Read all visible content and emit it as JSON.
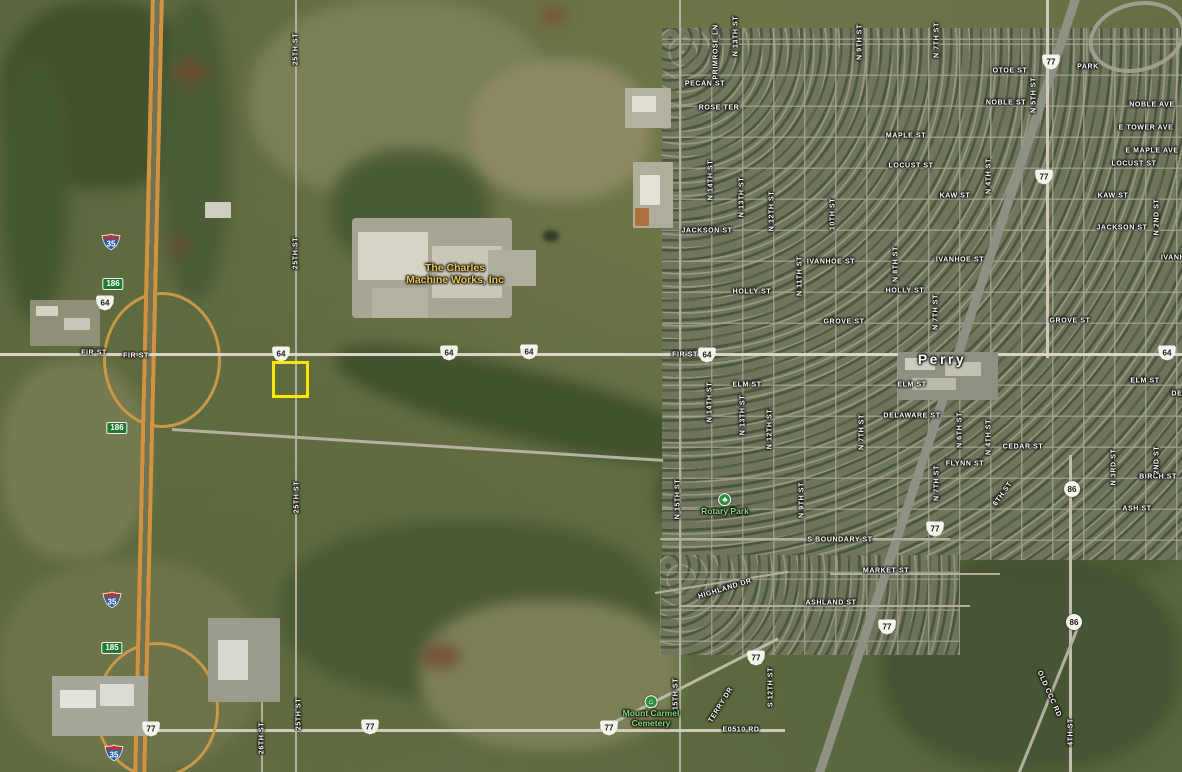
{
  "map": {
    "type": "satellite",
    "city": {
      "name": "Perry"
    },
    "selection": {
      "x": 272,
      "y": 361,
      "w": 31,
      "h": 31,
      "color": "#ffe800"
    },
    "pois": [
      {
        "name": "charles-machine-works",
        "style": "business",
        "x": 455,
        "y": 274,
        "lines": [
          "The Charles",
          "Machine Works, Inc"
        ]
      },
      {
        "name": "rotary-park",
        "style": "park",
        "icon": "tree-icon",
        "glyph": "♣",
        "x": 725,
        "y": 505,
        "lines": [
          "Rotary Park"
        ]
      },
      {
        "name": "mount-carmel-cemetery",
        "style": "park",
        "icon": "cemetery-icon",
        "glyph": "⌂",
        "x": 651,
        "y": 712,
        "lines": [
          "Mount Carmel",
          "Cemetery"
        ]
      }
    ],
    "street_labels": [
      {
        "t": "Perry",
        "x": 942,
        "y": 359,
        "k": "city"
      },
      {
        "t": "PECAN ST",
        "x": 705,
        "y": 84
      },
      {
        "t": "ROSE TER",
        "x": 719,
        "y": 108
      },
      {
        "t": "OTOE ST",
        "x": 1010,
        "y": 71
      },
      {
        "t": "PARK",
        "x": 1088,
        "y": 67
      },
      {
        "t": "NOBLE ST",
        "x": 1006,
        "y": 103
      },
      {
        "t": "NOBLE AVE",
        "x": 1152,
        "y": 105
      },
      {
        "t": "E TOWER AVE",
        "x": 1146,
        "y": 128
      },
      {
        "t": "E MAPLE AVE",
        "x": 1152,
        "y": 151
      },
      {
        "t": "MAPLE ST",
        "x": 906,
        "y": 136
      },
      {
        "t": "LOCUST ST",
        "x": 911,
        "y": 166
      },
      {
        "t": "LOCUST ST",
        "x": 1134,
        "y": 164
      },
      {
        "t": "KAW ST",
        "x": 955,
        "y": 196
      },
      {
        "t": "KAW ST",
        "x": 1113,
        "y": 196
      },
      {
        "t": "JACKSON ST",
        "x": 707,
        "y": 231
      },
      {
        "t": "JACKSON ST",
        "x": 1122,
        "y": 228
      },
      {
        "t": "IVANHOE ST",
        "x": 831,
        "y": 262
      },
      {
        "t": "IVANHOE ST",
        "x": 960,
        "y": 260
      },
      {
        "t": "IVANHOE ST",
        "x": 1185,
        "y": 258
      },
      {
        "t": "HOLLY ST",
        "x": 752,
        "y": 292
      },
      {
        "t": "HOLLY ST",
        "x": 905,
        "y": 291
      },
      {
        "t": "GROVE ST",
        "x": 844,
        "y": 322
      },
      {
        "t": "GROVE ST",
        "x": 1070,
        "y": 321
      },
      {
        "t": "FIR ST",
        "x": 94,
        "y": 353
      },
      {
        "t": "FIR ST",
        "x": 136,
        "y": 356
      },
      {
        "t": "FIR ST",
        "x": 685,
        "y": 355
      },
      {
        "t": "ELM ST",
        "x": 747,
        "y": 385
      },
      {
        "t": "ELM ST",
        "x": 912,
        "y": 385
      },
      {
        "t": "ELM ST",
        "x": 1145,
        "y": 381
      },
      {
        "t": "DELAWARE ST",
        "x": 912,
        "y": 416
      },
      {
        "t": "DELAWARE ST",
        "x": 1200,
        "y": 394
      },
      {
        "t": "CEDAR ST",
        "x": 1023,
        "y": 447
      },
      {
        "t": "FLYNN ST",
        "x": 965,
        "y": 464
      },
      {
        "t": "BIRCH ST",
        "x": 1158,
        "y": 477
      },
      {
        "t": "ASH ST",
        "x": 1137,
        "y": 509
      },
      {
        "t": "S BOUNDARY ST",
        "x": 840,
        "y": 540
      },
      {
        "t": "MARKET ST",
        "x": 886,
        "y": 571
      },
      {
        "t": "ASHLAND ST",
        "x": 831,
        "y": 603
      },
      {
        "t": "E0510 RD",
        "x": 741,
        "y": 730
      },
      {
        "t": "PRIMROSE LN",
        "x": 716,
        "y": 52,
        "r": -90
      },
      {
        "t": "N 13TH ST",
        "x": 736,
        "y": 36,
        "r": -90
      },
      {
        "t": "N 9TH ST",
        "x": 860,
        "y": 42,
        "r": -90
      },
      {
        "t": "N 7TH ST",
        "x": 937,
        "y": 40,
        "r": -90
      },
      {
        "t": "N 5TH ST",
        "x": 1034,
        "y": 95,
        "r": -90
      },
      {
        "t": "N 4TH ST",
        "x": 989,
        "y": 176,
        "r": -90
      },
      {
        "t": "N 2ND ST",
        "x": 1157,
        "y": 217,
        "r": -90
      },
      {
        "t": "N 14TH ST",
        "x": 711,
        "y": 180,
        "r": -90
      },
      {
        "t": "N 13TH ST",
        "x": 742,
        "y": 197,
        "r": -90
      },
      {
        "t": "N 12TH ST",
        "x": 772,
        "y": 211,
        "r": -90
      },
      {
        "t": "10TH ST",
        "x": 833,
        "y": 214,
        "r": -90
      },
      {
        "t": "N 11TH ST",
        "x": 800,
        "y": 276,
        "r": -90
      },
      {
        "t": "N 8TH ST",
        "x": 896,
        "y": 264,
        "r": -90
      },
      {
        "t": "N 7TH ST",
        "x": 936,
        "y": 312,
        "r": -90
      },
      {
        "t": "N 14TH ST",
        "x": 710,
        "y": 402,
        "r": -90
      },
      {
        "t": "N 13TH ST",
        "x": 743,
        "y": 415,
        "r": -90
      },
      {
        "t": "N 12TH ST",
        "x": 770,
        "y": 429,
        "r": -90
      },
      {
        "t": "N 7TH ST",
        "x": 862,
        "y": 432,
        "r": -90
      },
      {
        "t": "N 6TH ST",
        "x": 960,
        "y": 430,
        "r": -90
      },
      {
        "t": "N 7TH ST",
        "x": 937,
        "y": 483,
        "r": -90
      },
      {
        "t": "N 4TH ST",
        "x": 989,
        "y": 437,
        "r": -90
      },
      {
        "t": "N 3RD ST",
        "x": 1114,
        "y": 467,
        "r": -90
      },
      {
        "t": "2ND ST",
        "x": 1157,
        "y": 460,
        "r": -90
      },
      {
        "t": "N 15TH ST",
        "x": 678,
        "y": 499,
        "r": -90
      },
      {
        "t": "N 9TH ST",
        "x": 802,
        "y": 500,
        "r": -90
      },
      {
        "t": "15TH ST",
        "x": 676,
        "y": 694,
        "r": -90
      },
      {
        "t": "S 12TH ST",
        "x": 771,
        "y": 687,
        "r": -90
      },
      {
        "t": "25TH ST",
        "x": 296,
        "y": 49,
        "r": -90
      },
      {
        "t": "25TH ST",
        "x": 296,
        "y": 253,
        "r": -90
      },
      {
        "t": "25TH ST",
        "x": 297,
        "y": 497,
        "r": -90
      },
      {
        "t": "25TH ST",
        "x": 299,
        "y": 714,
        "r": -90
      },
      {
        "t": "26TH ST",
        "x": 262,
        "y": 738,
        "r": -90
      },
      {
        "t": "4TH ST",
        "x": 1071,
        "y": 732,
        "r": -90
      },
      {
        "t": "6TH ST",
        "x": 1003,
        "y": 494,
        "r": -55
      },
      {
        "t": "HIGHLAND DR",
        "x": 725,
        "y": 589,
        "r": -17
      },
      {
        "t": "TERRY DR",
        "x": 721,
        "y": 705,
        "r": -58
      },
      {
        "t": "OLD CCC RD",
        "x": 1049,
        "y": 694,
        "r": 66
      }
    ],
    "shields": [
      {
        "type": "interstate",
        "v": "35",
        "x": 111,
        "y": 242
      },
      {
        "type": "interstate",
        "v": "35",
        "x": 112,
        "y": 600
      },
      {
        "type": "interstate",
        "v": "35",
        "x": 114,
        "y": 753
      },
      {
        "type": "us",
        "v": "64",
        "x": 105,
        "y": 303
      },
      {
        "type": "us",
        "v": "64",
        "x": 281,
        "y": 354
      },
      {
        "type": "us",
        "v": "64",
        "x": 449,
        "y": 353
      },
      {
        "type": "us",
        "v": "64",
        "x": 529,
        "y": 352
      },
      {
        "type": "us",
        "v": "64",
        "x": 707,
        "y": 355
      },
      {
        "type": "us",
        "v": "64",
        "x": 1167,
        "y": 353
      },
      {
        "type": "us",
        "v": "77",
        "x": 1051,
        "y": 62
      },
      {
        "type": "us",
        "v": "77",
        "x": 1044,
        "y": 177
      },
      {
        "type": "us",
        "v": "77",
        "x": 935,
        "y": 529
      },
      {
        "type": "us",
        "v": "77",
        "x": 887,
        "y": 627
      },
      {
        "type": "us",
        "v": "77",
        "x": 756,
        "y": 658
      },
      {
        "type": "us",
        "v": "77",
        "x": 609,
        "y": 728
      },
      {
        "type": "us",
        "v": "77",
        "x": 370,
        "y": 727
      },
      {
        "type": "us",
        "v": "77",
        "x": 151,
        "y": 729
      },
      {
        "type": "exit",
        "v": "186",
        "x": 113,
        "y": 284
      },
      {
        "type": "exit",
        "v": "186",
        "x": 117,
        "y": 428
      },
      {
        "type": "exit",
        "v": "185",
        "x": 112,
        "y": 648
      },
      {
        "type": "circle",
        "v": "86",
        "x": 1072,
        "y": 489
      },
      {
        "type": "circle",
        "v": "86",
        "x": 1074,
        "y": 622
      }
    ]
  }
}
